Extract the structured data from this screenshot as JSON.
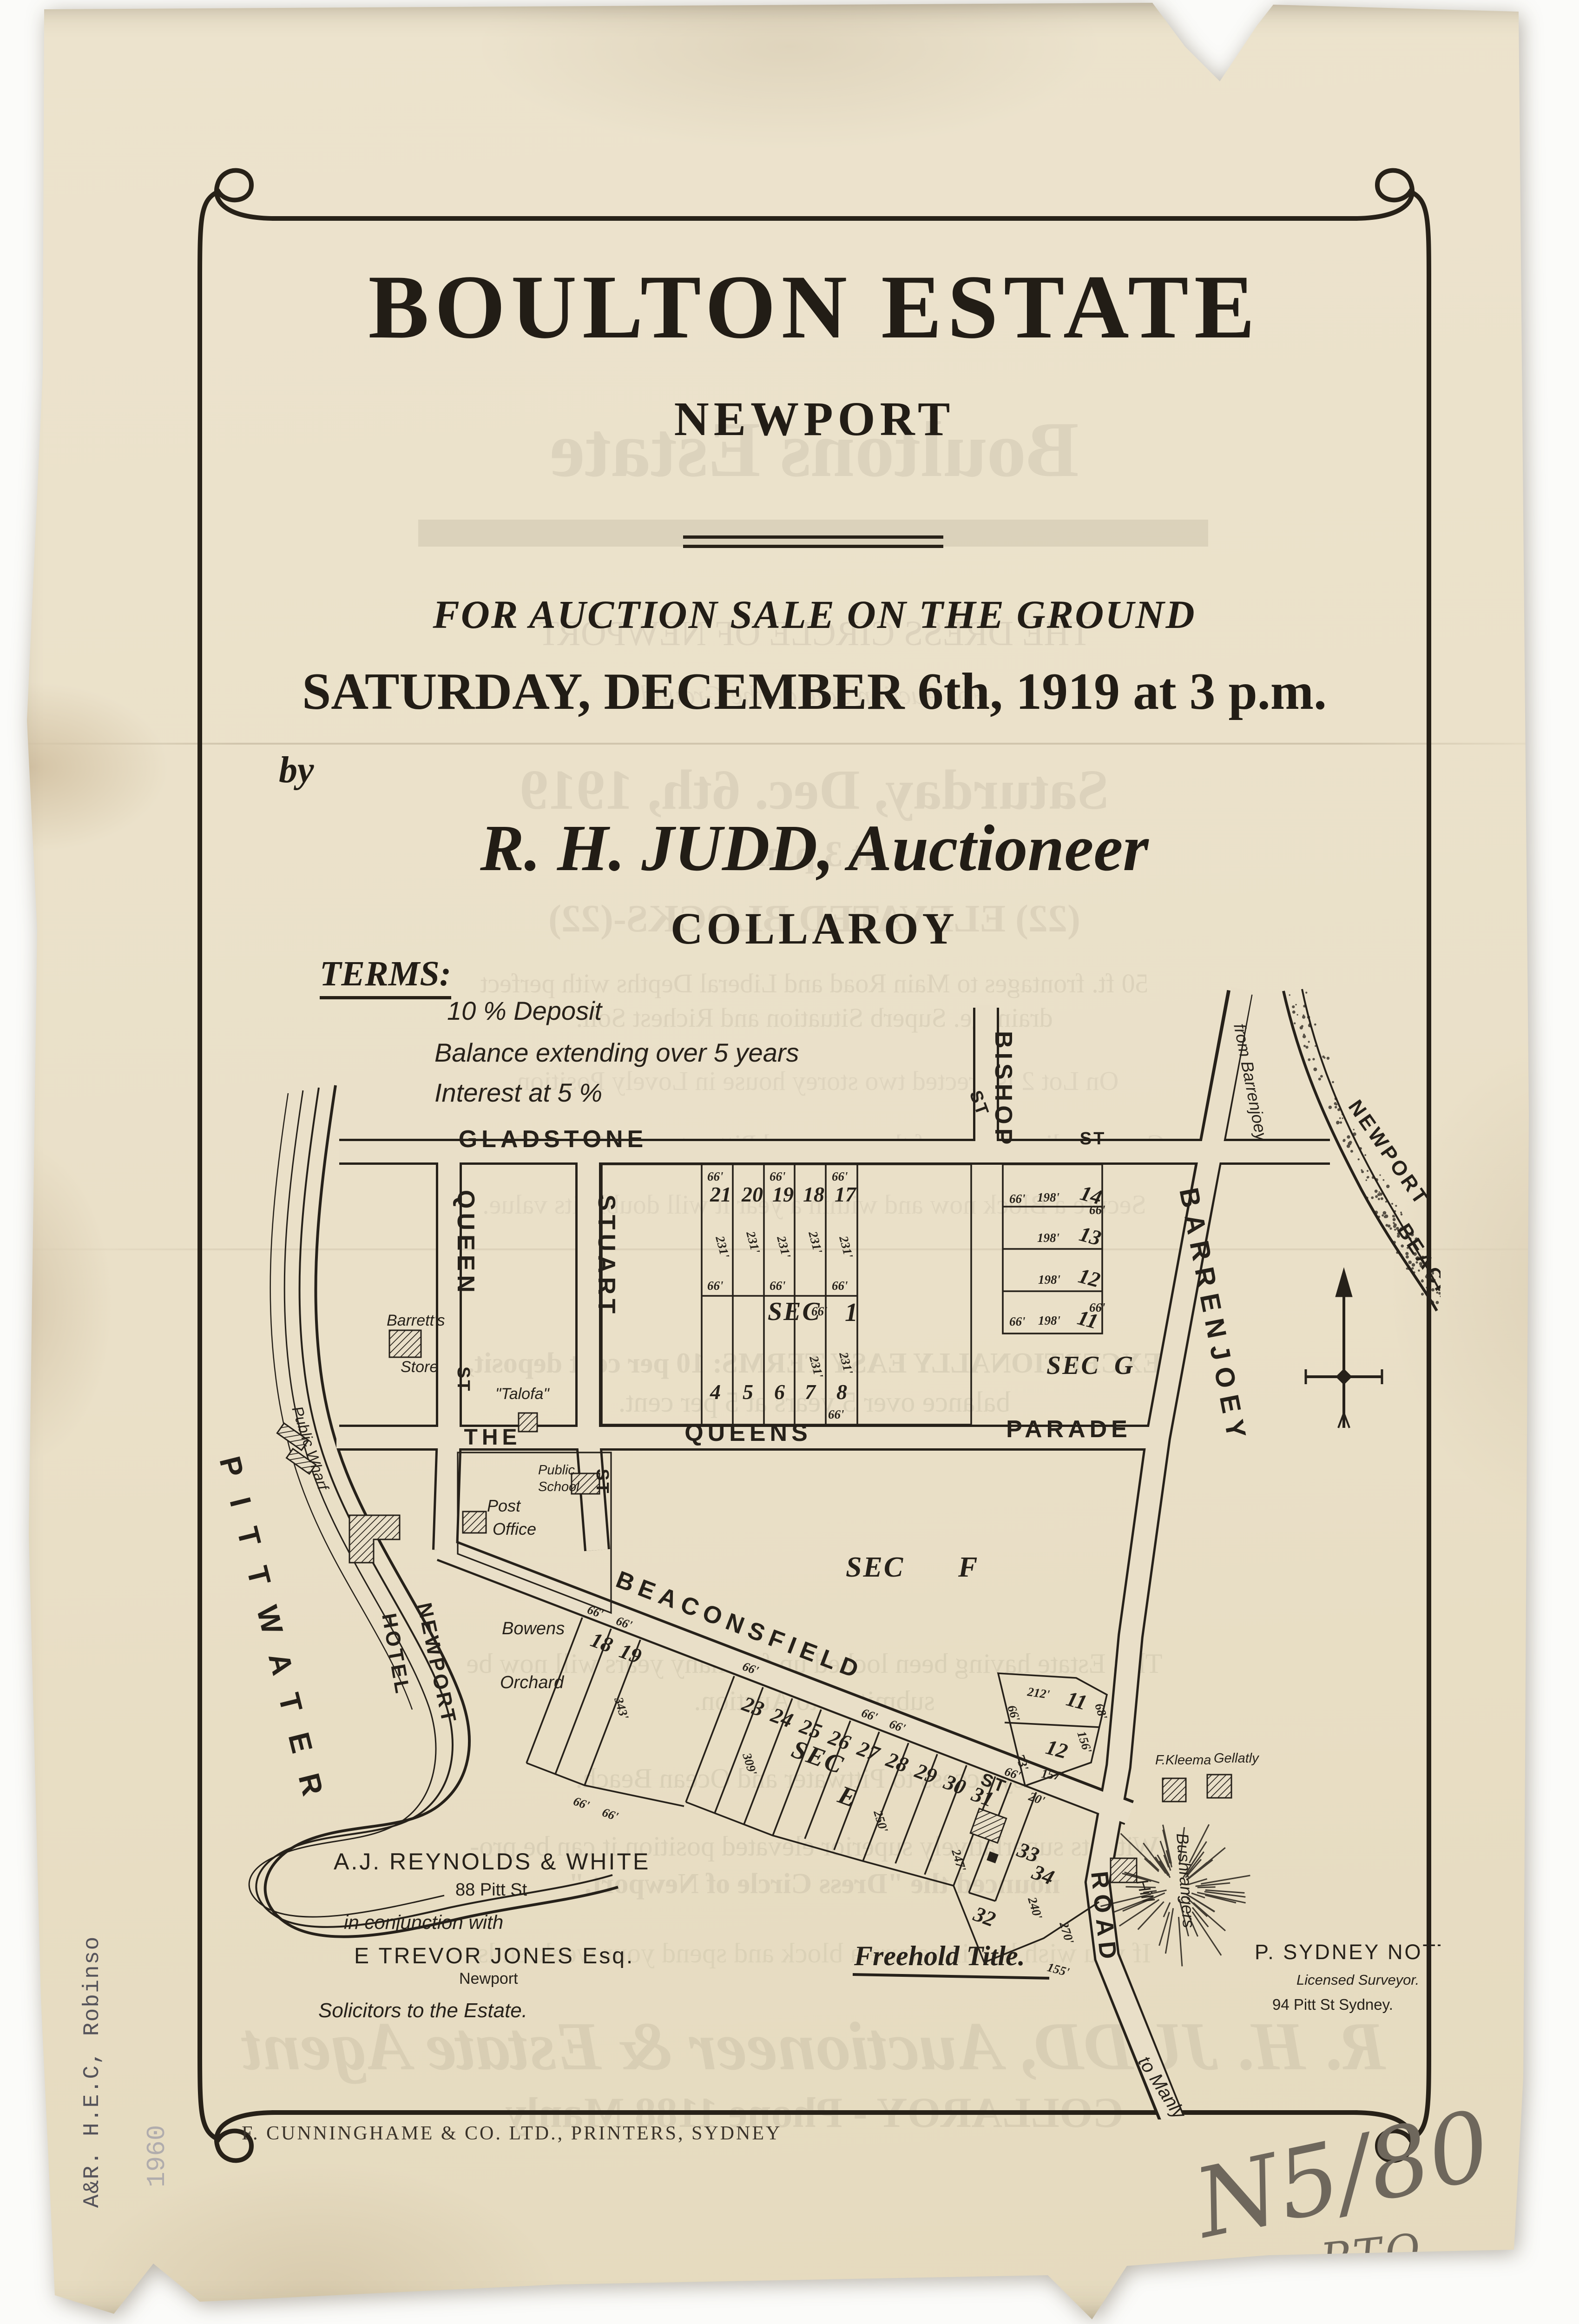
{
  "header": {
    "title": "BOULTON ESTATE",
    "subtitle": "NEWPORT",
    "sale_line": "FOR AUCTION SALE ON THE GROUND",
    "date_line": "SATURDAY, DECEMBER 6th, 1919 at 3 p.m.",
    "by": "by",
    "auctioneer": "R. H. JUDD, Auctioneer",
    "auctioneer_place": "COLLAROY"
  },
  "terms": {
    "heading": "TERMS:",
    "line1": "10 % Deposit",
    "line2": "Balance extending over 5 years",
    "line3": "Interest at 5 %"
  },
  "map": {
    "streets": {
      "gladstone": "GLADSTONE",
      "st": "ST",
      "queen": "QUEEN",
      "stuart": "STUART",
      "bishop": "BISHOP",
      "barrenjoey": "BARRENJOEY",
      "road": "ROAD",
      "the": "THE",
      "queens": "QUEENS",
      "parade": "PARADE",
      "beaconsfield": "BEACONSFIELD",
      "from_barrenjoey": "from Barrenjoey",
      "to_manly": "to Manly"
    },
    "places": {
      "pittwater": "PITTWATER",
      "newport": "NEWPORT",
      "beach": "BEACH",
      "public_wharf": "Public Wharf",
      "barretts": "Barrett's",
      "store": "Store",
      "talofa": "\"Talofa\"",
      "public_w": "Public",
      "school": "School",
      "post": "Post",
      "office": "Office",
      "hotel_newport": "NEWPORT",
      "hotel": "HOTEL",
      "bowens": "Bowens",
      "orchard": "Orchard",
      "bushrangers": "Bushrangers",
      "hill": "Hill",
      "kleema": "F.Kleema",
      "gellatly": "Gellatly"
    },
    "sections": {
      "sec": "SEC",
      "one": "1",
      "g": "G",
      "f": "F",
      "e": "E"
    },
    "sec1_top": [
      "21",
      "20",
      "19",
      "18",
      "17"
    ],
    "sec1_bottom": [
      "4",
      "5",
      "6",
      "7",
      "8"
    ],
    "secg_lots": [
      "14",
      "13",
      "12",
      "11"
    ],
    "blockh_lots": [
      "11",
      "12"
    ],
    "sece_a": [
      "18",
      "19"
    ],
    "sece_b": [
      "23",
      "24",
      "25",
      "26",
      "27",
      "28",
      "29",
      "30",
      "31"
    ],
    "sece_c": [
      "33",
      "34"
    ],
    "lot32": "32",
    "dims": {
      "d20": "20'",
      "d66": "66'",
      "d68": "68'",
      "d73": "73'",
      "d155": "155'",
      "d156": "156'",
      "d157": "157'",
      "d198": "198'",
      "d212": "212'",
      "d231": "231'",
      "d240": "240'",
      "d247": "247'",
      "d250": "250'",
      "d270": "270'",
      "d309": "309'",
      "d343": "343'"
    }
  },
  "surveyor": {
    "name": "P. SYDNEY NOTT",
    "role": "Licensed Surveyor.",
    "address": "94 Pitt St Sydney."
  },
  "solicitors": {
    "firm": "A.J. REYNOLDS & WHITE",
    "firm_address": "88 Pitt St",
    "conjunction": "in conjunction with",
    "partner": "E TREVOR JONES Esq.",
    "partner_place": "Newport",
    "role": "Solicitors to the Estate."
  },
  "tenure": "Freehold Title.",
  "printer": "F. CUNNINGHAME & CO. LTD., PRINTERS, SYDNEY",
  "stamps": {
    "library": "A&R. H.E.C, Robinso",
    "number": "1960"
  },
  "handwriting": {
    "reference": "N5/80",
    "pto": "PTO"
  },
  "show_through": [
    "Boultons Estate",
    "THE DRESS CIRCLE OF NEWPORT",
    "For Auction Sale on the Ground",
    "Saturday, Dec. 6th, 1919",
    "at 3 p.m.",
    "(22) ELEVATED BLOCKS-(22)",
    "50 ft. frontages to Main Road and Liberal Depths with perfect",
    "drainage. Superb Situation and Richest Soil.",
    "On Lot 2 is erected two storey house in Lovely Position.",
    "Commanding Views of the renowned Pittwater and Ocean Beach",
    "Secure a Block now and within a year it will double its value.",
    "EXCEPTIONALLY EASY TERMS:   10 per cent deposit,",
    "balance over 5 years at 5 per cent.",
    "This Estate having been locked up for many years will now be",
    "submitted to Auction.",
    "Easy access to Pittwater and Ocean Beach.",
    "With its superlatively superior elevated position it can be pro-",
    "nounced the \"Dress Circle of Newport.\"",
    "If you wish herein secure a block and spend your week-ends",
    "R. H. JUDD, Auctioneer & Estate Agent",
    "COLLAROY   -   Phone 1188 Manly"
  ]
}
